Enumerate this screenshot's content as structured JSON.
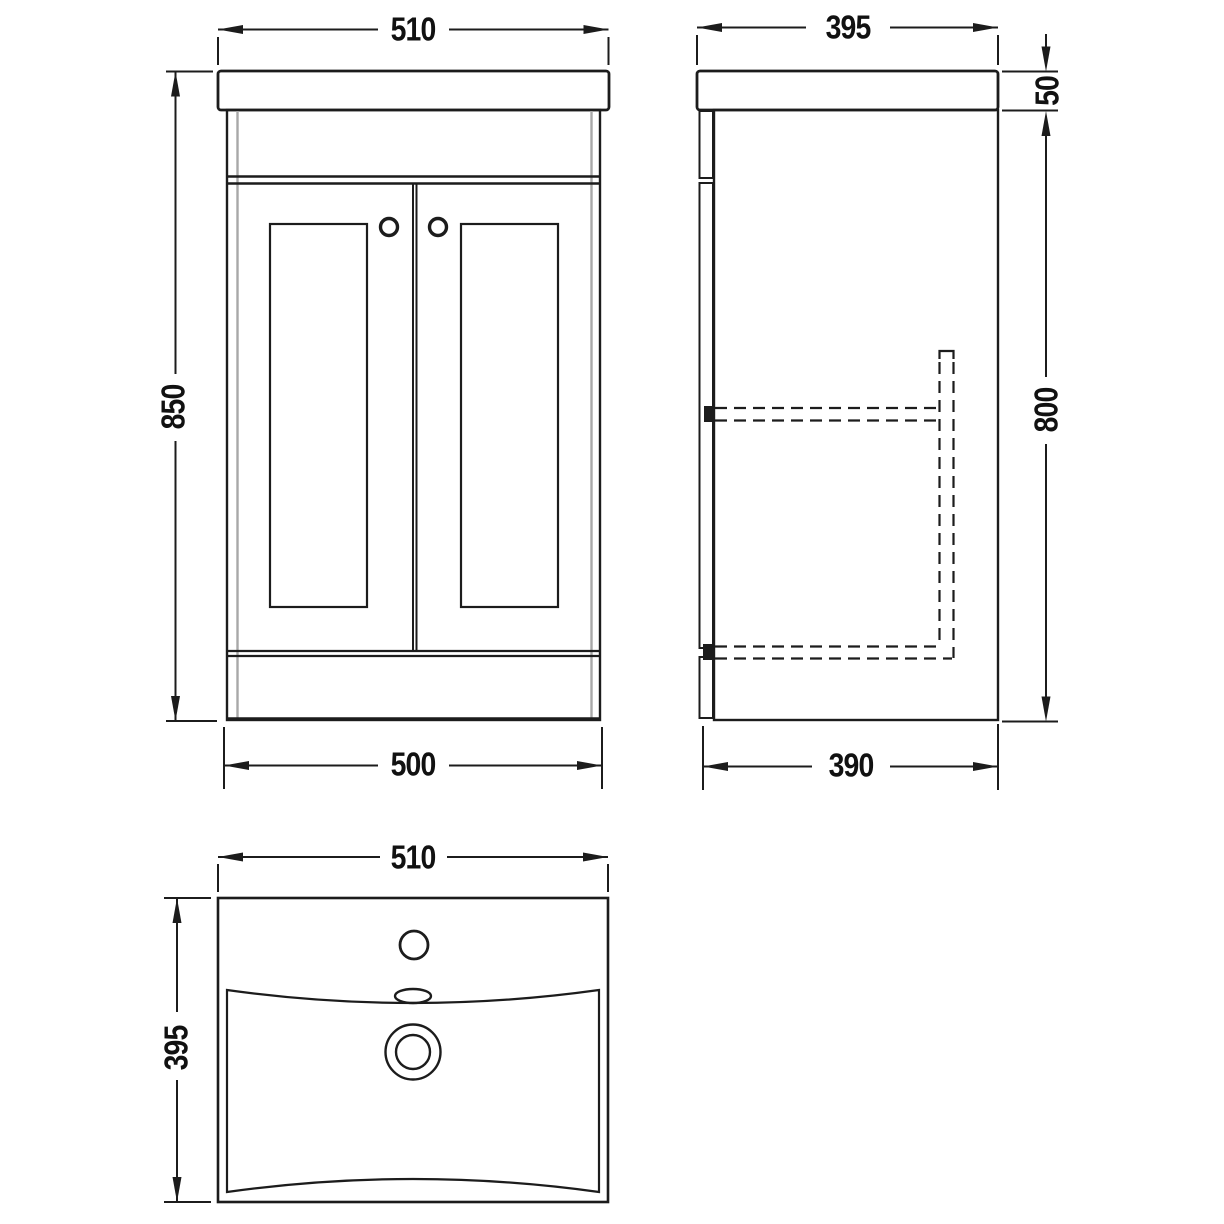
{
  "drawing": {
    "type": "technical-orthographic-drawing",
    "subject": "vanity-unit-with-basin",
    "line_color": "#1c1c1c",
    "hidden_line_color": "#1c1c1c",
    "panel_edge_color": "#a8a8a8",
    "background_color": "#ffffff",
    "views": {
      "front": {
        "dims": {
          "top_width": "510",
          "overall_height": "850",
          "base_width": "500"
        }
      },
      "side": {
        "dims": {
          "top_depth": "395",
          "worktop_thickness": "50",
          "cabinet_height": "800",
          "base_depth": "390"
        }
      },
      "plan": {
        "dims": {
          "basin_width": "510",
          "basin_depth": "395"
        }
      }
    }
  }
}
